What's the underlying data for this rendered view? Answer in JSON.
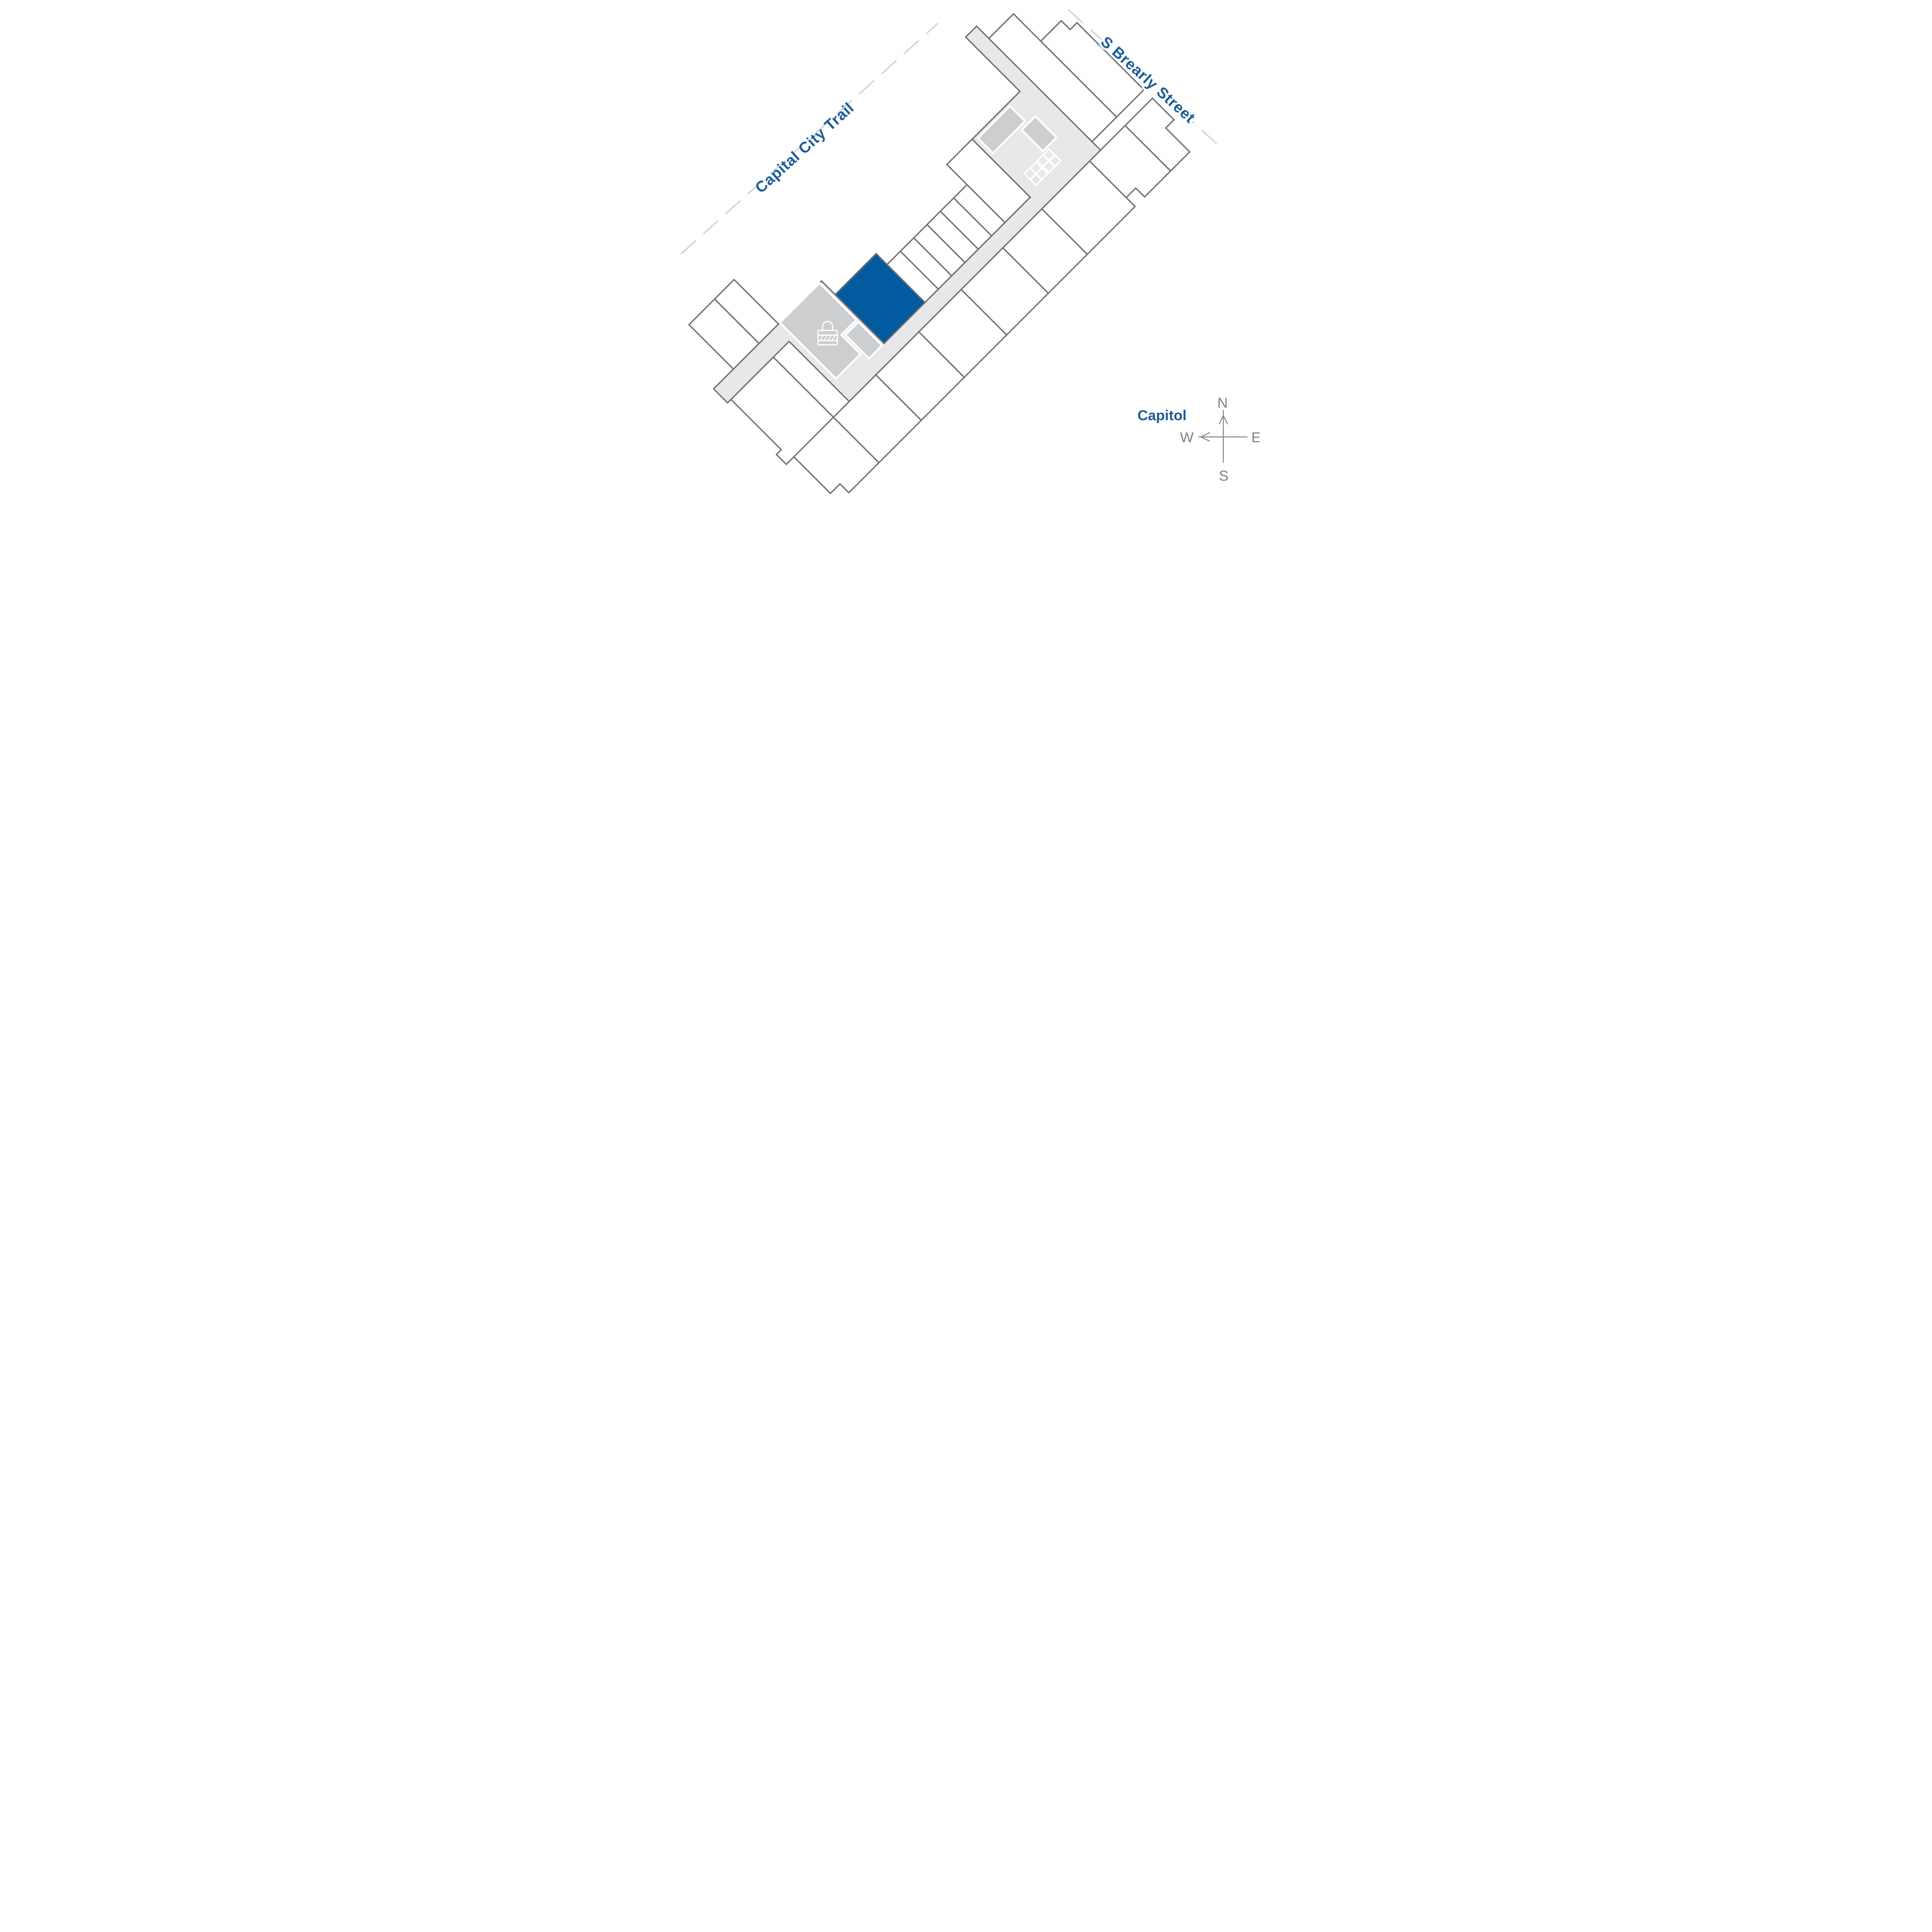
{
  "labels": {
    "trail": "Capital City Trail",
    "street": "S Brearly Street",
    "landmark": "Capitol",
    "compass": {
      "north": "N",
      "south": "S",
      "east": "E",
      "west": "W"
    }
  },
  "colors": {
    "label_blue": "#1a5c9e",
    "unit_highlight": "#015b9e",
    "dashed_line": "#d2d3d4",
    "compass_gray": "#808285",
    "wall_gray": "#717275",
    "corridor_gray": "#e8e8ea",
    "service_gray": "#cdced0"
  },
  "icons": {
    "lock": "lock-icon",
    "elevator": "elevator-x-icon",
    "north_arrow": "north-arrow-icon",
    "west_arrow": "west-arrow-icon"
  },
  "plan": {
    "highlighted_units": 1,
    "elevator_count": 2
  }
}
